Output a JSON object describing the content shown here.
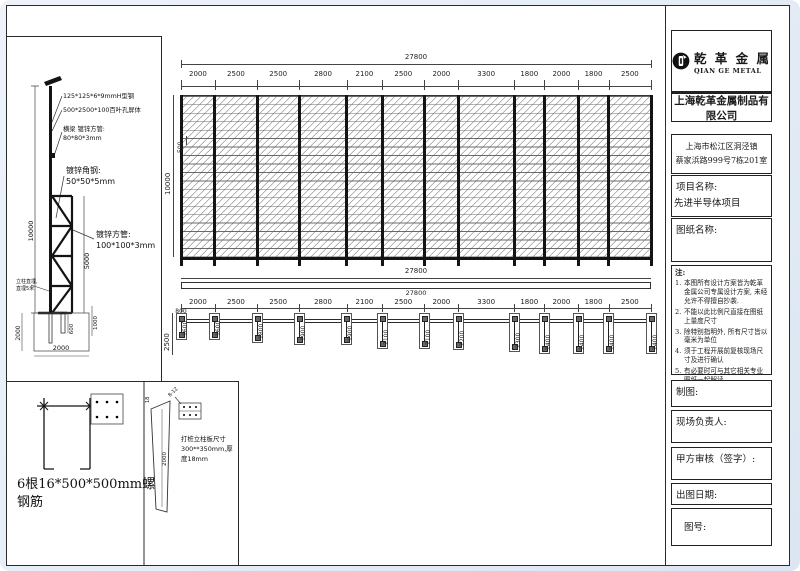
{
  "title_block": {
    "logo_cn": "乾 革 金 属",
    "logo_en": "QIAN GE METAL",
    "company": "上海乾革金属制品有限公司",
    "address_line1": "上海市松江区洞泾镇",
    "address_line2": "蔡家浜路999号7栋201室",
    "project_label": "项目名称:",
    "project_value": "先进半导体项目",
    "drawing_label": "图纸名称:",
    "notes_title": "注:",
    "notes": [
      {
        "num": "1.",
        "text": "本图所有设计方案皆为乾革金属公司专属设计方案, 未经允许不得擅自抄袭."
      },
      {
        "num": "2.",
        "text": "不能以此比例尺直接在图纸上量度尺寸"
      },
      {
        "num": "3.",
        "text": "除特别指明外, 所有尺寸皆以毫米为单位"
      },
      {
        "num": "4.",
        "text": "须于工程开展前复核现场尺寸及进行确认"
      },
      {
        "num": "5.",
        "text": "有必要时可与其它相关专业图纸一起解读."
      }
    ],
    "field_draft": "制图:",
    "field_site": "现场负责人:",
    "field_review": "甲方审核（签字）:",
    "field_date": "出图日期:",
    "field_number": "图号:"
  },
  "elevation": {
    "total_label": "27800",
    "segments": [
      "2000",
      "2500",
      "2500",
      "2800",
      "2100",
      "2500",
      "2000",
      "3300",
      "1800",
      "2000",
      "1800",
      "2500"
    ],
    "segments_mm": [
      2000,
      2500,
      2500,
      2800,
      2100,
      2500,
      2000,
      3300,
      1800,
      2000,
      1800,
      2500
    ],
    "height_label": "10000",
    "band_label": "500"
  },
  "plan": {
    "total_label": "27800",
    "bar_label": "27800",
    "left_dim": "2500",
    "first_width_dim": "800",
    "post_depth_labels": [
      "1600",
      "1600",
      "1800",
      "1900",
      "1900",
      "2100",
      "2100",
      "2200",
      "2300",
      "2400",
      "2400",
      "2400",
      "2400"
    ],
    "post_depths_mm": [
      1600,
      1600,
      1800,
      1900,
      1900,
      2100,
      2100,
      2200,
      2300,
      2400,
      2400,
      2400,
      2400
    ]
  },
  "post_detail": {
    "callout_h_beam": "125*125*6*9mmH型钢",
    "callout_louver": "500*2500*100百叶孔屏体",
    "callout_beam_1": "横梁 镀锌方管:",
    "callout_beam_2": "80*80*3mm",
    "callout_angle_1": "镀锌角钢:",
    "callout_angle_2": "50*50*5mm",
    "callout_tube_1": "镀锌方管:",
    "callout_tube_2": "100*100*3mm",
    "dim_height": "10000",
    "dim_truss": "5000",
    "dim_base_left": "2000",
    "dim_600": "600",
    "dim_1000": "1000",
    "dim_base_width": "2000",
    "note_line1": "立柱直埋,",
    "note_line2": "直埋5米"
  },
  "anchor_detail": {
    "caption_line1": "6根16*500*500mm螺纹",
    "caption_line2": "钢筋"
  },
  "pile_detail": {
    "dim_top": "18",
    "dim_depth": "2000",
    "bolt_label": "8-12",
    "caption_line1": "打桩立柱板尺寸",
    "caption_line2": "300**350mm,厚",
    "caption_line3": "度18mm"
  }
}
